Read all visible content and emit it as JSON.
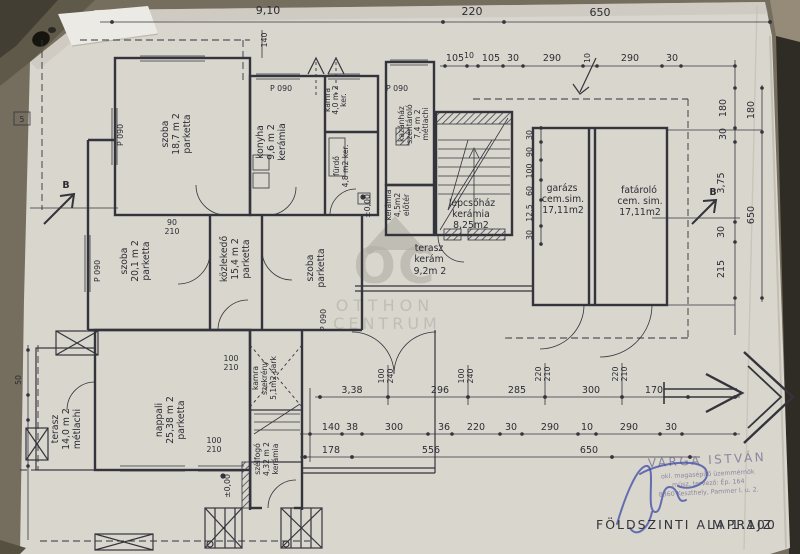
{
  "title": {
    "text": "FÖLDSZINTI  ALAPRAJZ",
    "scale": "M 1:100"
  },
  "watermark": {
    "logo": "OC",
    "line1": "OTTHON",
    "line2": "CENTRUM"
  },
  "stamp": {
    "name": "VARGA ISTVÁN",
    "line2": "okl. magasépítő üzemmérnök",
    "line3": "műsz. tervező: Ép. 164",
    "line4": "8360 Keszthely, Pammer I. u. 2."
  },
  "rooms": {
    "szoba1": {
      "name": "szoba",
      "area": "18,7 m 2",
      "floor": "parketta"
    },
    "konyha": {
      "name": "konyha",
      "area": "9,6 m 2",
      "floor": "kerámia"
    },
    "kamra": {
      "name": "kamra",
      "area": "4,0 m 2",
      "floor": "ker."
    },
    "furdo": {
      "name": "fürdő",
      "area": "4,8 m2 ker."
    },
    "kazanhaz": {
      "name": "kazánház",
      "name2": "széntároló",
      "area": "7,4 m 2",
      "floor": "métlachi"
    },
    "lepcsohaz": {
      "name": "lépcsőház",
      "floor": "kerámia",
      "area": "8,25m2"
    },
    "eloter": {
      "name": "előtér",
      "area": "4,5m2",
      "floor": "kerámia"
    },
    "terasz_kozep": {
      "name": "terasz",
      "floor": "kerám",
      "area": "9,2m 2"
    },
    "szoba2": {
      "name": "szoba",
      "area": "20,1 m 2",
      "floor": "parketta"
    },
    "kozlekedo": {
      "name": "közlekedő",
      "area": "15,4 m 2",
      "floor": "parketta"
    },
    "szoba3": {
      "name": "szoba",
      "floor": "parketta"
    },
    "nappali": {
      "name": "nappali",
      "area": "25,38 m 2",
      "floor": "parketta"
    },
    "terasz_bal": {
      "name": "terasz",
      "area": "14,0 m 2",
      "floor": "métlachi"
    },
    "szelfogo": {
      "name": "szélfogó",
      "area": "4,32 m 2",
      "floor": "kerámia"
    },
    "kamra2": {
      "name": "kamra",
      "name2": "szekrény",
      "area": "5,1m2 park"
    },
    "garazs": {
      "name": "garázs",
      "floor": "cem.sim.",
      "area": "17,11m2"
    },
    "fatarolo": {
      "name": "fatároló",
      "floor": "cem. sim.",
      "area": "17,11m2"
    }
  },
  "dims": {
    "top1": [
      "9,10",
      "220",
      "650"
    ],
    "top2": [
      "105",
      "10",
      "105",
      "30",
      "290",
      "10",
      "290",
      "30"
    ],
    "right_inner": [
      "180",
      "30",
      "3,75",
      "30",
      "215"
    ],
    "right_outer": [
      "180",
      "650"
    ],
    "garage_col": [
      "30",
      "90",
      "100",
      "60",
      "12,5",
      "30"
    ],
    "bottom1": [
      "3,38",
      "296",
      "285",
      "300",
      "170"
    ],
    "openings1": [
      "100",
      "240",
      "100",
      "240",
      "220",
      "210",
      "220",
      "210"
    ],
    "bottom2": [
      "140",
      "38",
      "300",
      "36",
      "220",
      "30",
      "290",
      "10",
      "290",
      "30"
    ],
    "bottom3": [
      "178",
      "556",
      "650"
    ],
    "left": [
      "5",
      "50",
      "140"
    ],
    "doors": [
      "90",
      "210",
      "100",
      "210",
      "100",
      "210"
    ],
    "window_label": "P 090",
    "level": "±0,00"
  },
  "markers": {
    "section": "B"
  }
}
